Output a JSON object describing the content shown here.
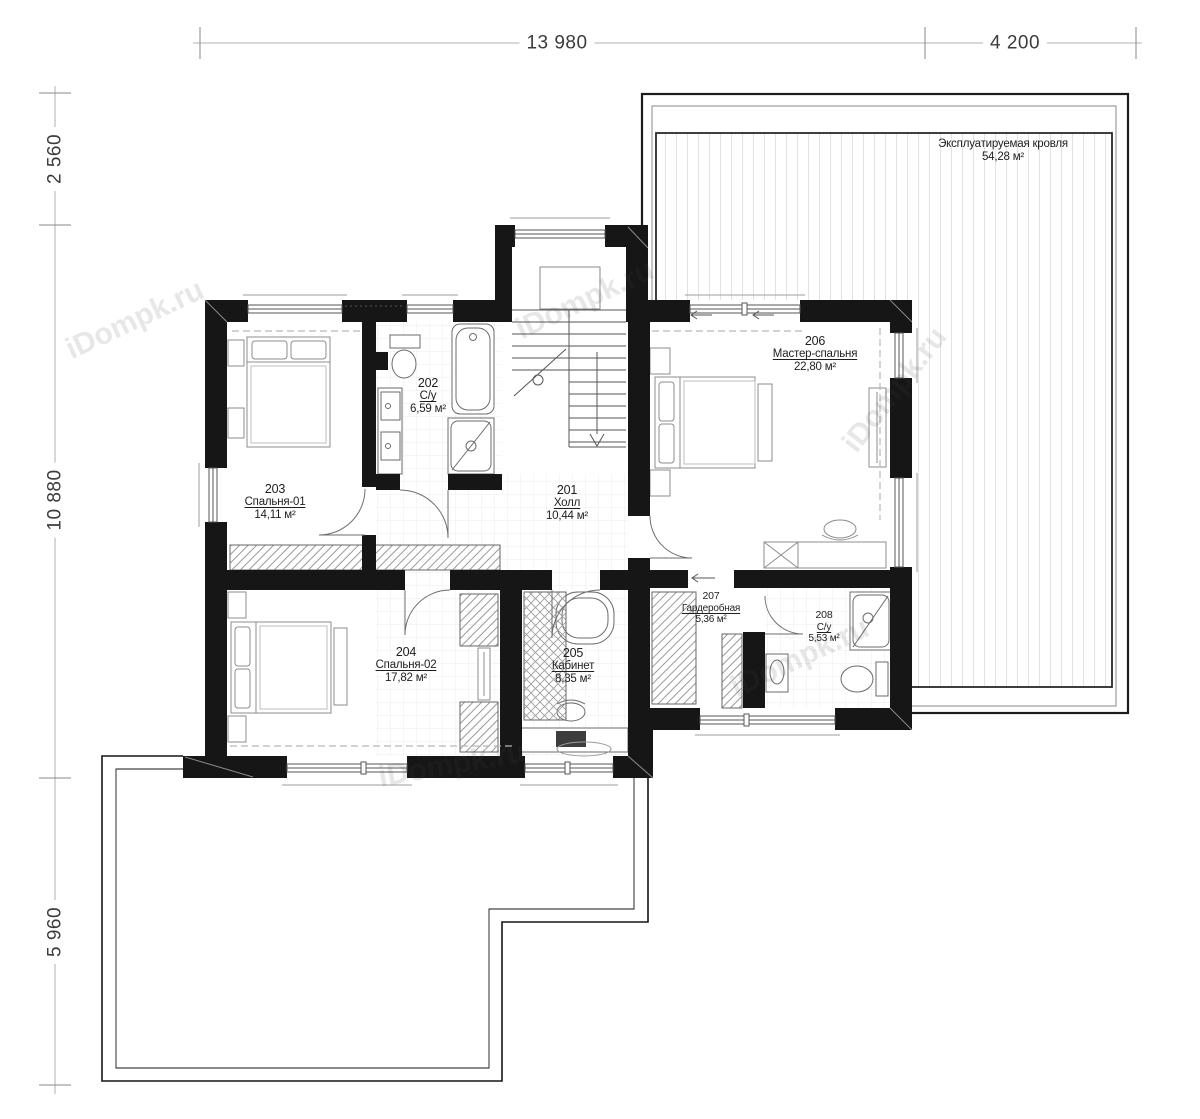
{
  "watermark": "iDompk.ru",
  "dimensions": {
    "top": [
      {
        "label": "13 980"
      },
      {
        "label": "4 200"
      }
    ],
    "left": [
      {
        "label": "2 560"
      },
      {
        "label": "10 880"
      },
      {
        "label": "5 960"
      }
    ]
  },
  "roof": {
    "name": "Эксплуатируемая кровля",
    "area": "54,28 м²"
  },
  "rooms": [
    {
      "id": "201",
      "name": "Холл",
      "area": "10,44 м²"
    },
    {
      "id": "202",
      "name": "С/у",
      "area": "6,59 м²"
    },
    {
      "id": "203",
      "name": "Спальня-01",
      "area": "14,11 м²"
    },
    {
      "id": "204",
      "name": "Спальня-02",
      "area": "17,82 м²"
    },
    {
      "id": "205",
      "name": "Кабинет",
      "area": "8,35 м²"
    },
    {
      "id": "206",
      "name": "Мастер-спальня",
      "area": "22,80 м²"
    },
    {
      "id": "207",
      "name": "Гардеробная",
      "area": "5,36 м²"
    },
    {
      "id": "208",
      "name": "С/у",
      "area": "5,53 м²"
    }
  ]
}
